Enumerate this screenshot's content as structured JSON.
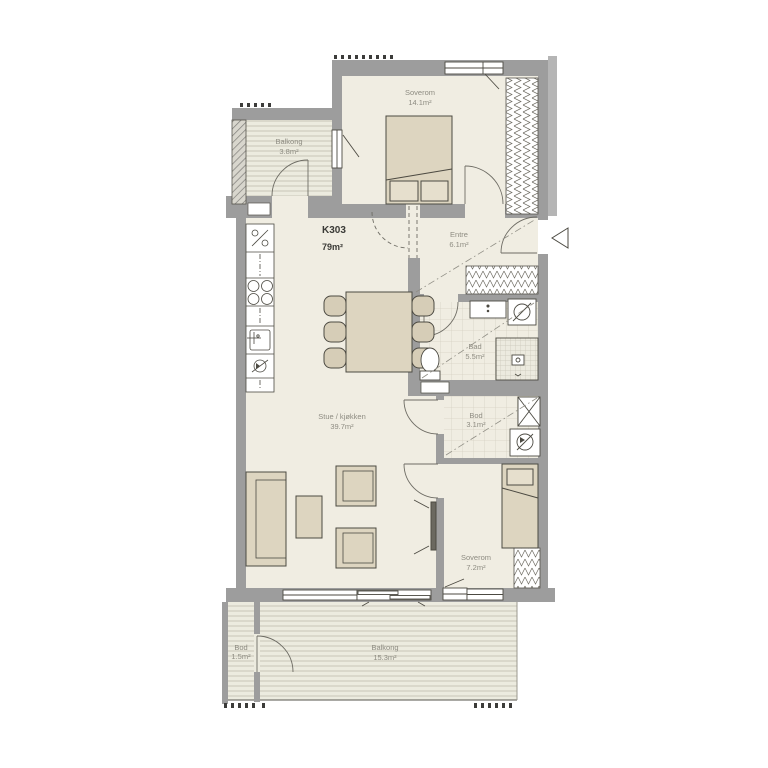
{
  "plan": {
    "unit_label": "K303",
    "unit_area": "79m²",
    "rooms": [
      {
        "id": "soverom1",
        "name": "Soverom",
        "area": "14.1m²"
      },
      {
        "id": "balkong1",
        "name": "Balkong",
        "area": "3.8m²"
      },
      {
        "id": "entre",
        "name": "Entre",
        "area": "6.1m²"
      },
      {
        "id": "bad",
        "name": "Bad",
        "area": "5.5m²"
      },
      {
        "id": "bod",
        "name": "Bod",
        "area": "3.1m²"
      },
      {
        "id": "stue_kjokken",
        "name": "Stue / kjøkken",
        "area": "39.7m²"
      },
      {
        "id": "soverom2",
        "name": "Soverom",
        "area": "7.2m²"
      },
      {
        "id": "bod_ute",
        "name": "Bod",
        "area": "1.5m²"
      },
      {
        "id": "balkong2",
        "name": "Balkong",
        "area": "15.3m²"
      }
    ],
    "colors": {
      "wall": "#9d9d9d",
      "wall_light": "#b5b5b5",
      "floor": "#f0ede2",
      "deck": "#ecebdf",
      "deck_stripe": "#c7c5b7",
      "furniture": "#ddd5c0",
      "outline": "#4c4a42",
      "label_text": "#8e8c82",
      "unit_text": "#3a3a36"
    }
  }
}
